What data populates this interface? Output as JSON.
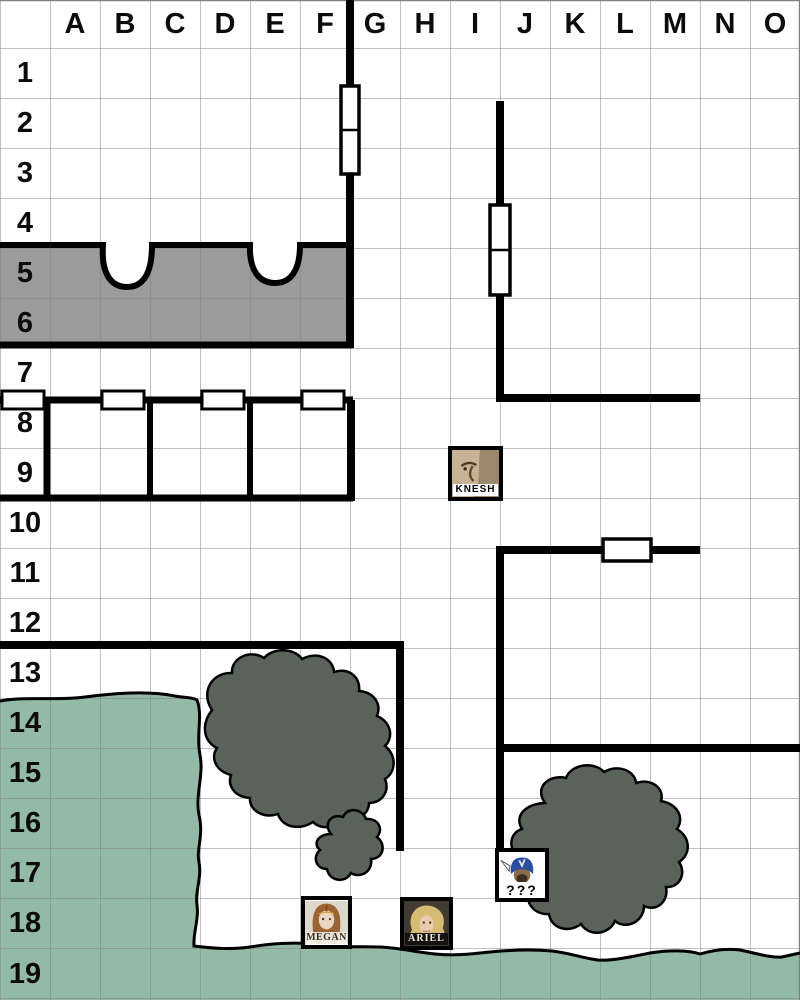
{
  "map": {
    "columns": [
      "A",
      "B",
      "C",
      "D",
      "E",
      "F",
      "G",
      "H",
      "I",
      "J",
      "K",
      "L",
      "M",
      "N",
      "O"
    ],
    "rows": [
      "1",
      "2",
      "3",
      "4",
      "5",
      "6",
      "7",
      "8",
      "9",
      "10",
      "11",
      "12",
      "13",
      "14",
      "15",
      "16",
      "17",
      "18",
      "19"
    ]
  },
  "colors": {
    "background": "#ffffff",
    "grid_line": "#808080",
    "wall": "#000000",
    "door_fill": "#ffffff",
    "room_gray": "#9b9b9b",
    "water": "#93b9a7",
    "tree": "#5a635a",
    "knesh_skin": "#c7b294",
    "unknown_helmet": "#2b4da0",
    "megan_hair": "#9c6434",
    "ariel_hair": "#d6bc72"
  },
  "tokens": [
    {
      "id": "knesh",
      "label": "KNESH",
      "cell": "I9"
    },
    {
      "id": "unknown",
      "label": "???",
      "cell": "J17"
    },
    {
      "id": "megan",
      "label": "MEGAN",
      "cell": "F18"
    },
    {
      "id": "ariel",
      "label": "ARIEL",
      "cell": "H18"
    }
  ]
}
